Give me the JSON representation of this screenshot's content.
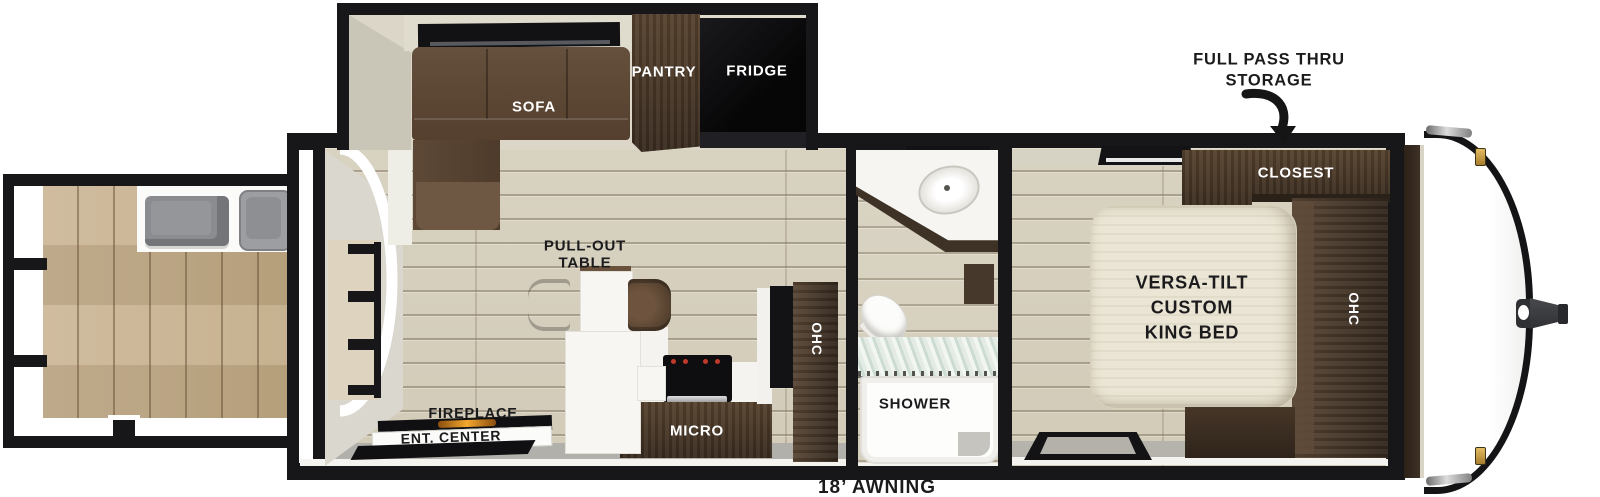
{
  "annotations": {
    "storage_line1": "FULL PASS THRU",
    "storage_line2": "STORAGE",
    "awning": "18’ AWNING"
  },
  "living": {
    "sofa": "SOFA",
    "pantry": "PANTRY",
    "fridge": "FRIDGE",
    "table_line1": "PULL-OUT",
    "table_line2": "TABLE",
    "fireplace": "FIREPLACE",
    "ent_center": "ENT. CENTER",
    "micro": "MICRO",
    "ohc": "OHC"
  },
  "bathroom": {
    "shower": "SHOWER"
  },
  "bedroom": {
    "bed_line1": "VERSA-TILT",
    "bed_line2": "CUSTOM",
    "bed_line3": "KING BED",
    "closet": "CLOSEST",
    "ohc": "OHC"
  },
  "icons": {
    "storage_arrow": "curved-arrow-down"
  },
  "colors": {
    "wall_black": "#17171a",
    "floor_plank": "#d6d0c0",
    "deck_wood": "#c6b08f",
    "cabinet_dark_wood": "#4a392c",
    "sofa_brown": "#5d4a39",
    "fridge_black": "#0c0c0e",
    "fireplace_glow": "#e8921e",
    "shower_glass": "#dfe8e3",
    "marker_light_gold": "#c9a24a"
  }
}
